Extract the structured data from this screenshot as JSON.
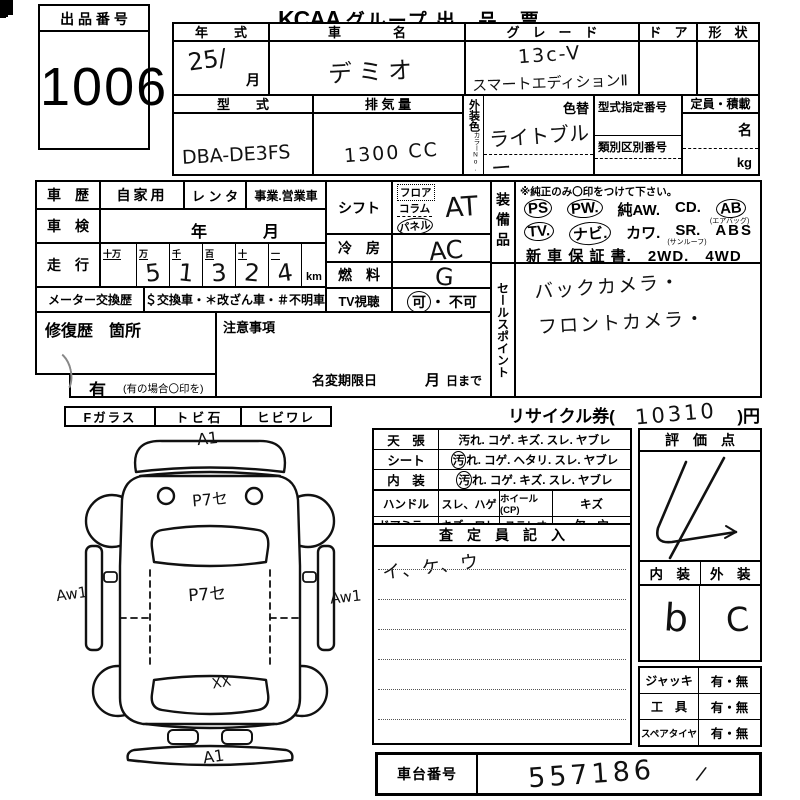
{
  "header": {
    "lot_label": "出 品 番 号",
    "lot_number": "1006",
    "brand": "KCAA",
    "title": "グループ 出　品　票",
    "audience": "主 催 者 用"
  },
  "row1": {
    "year_label": "年　　式",
    "year_value": "25/",
    "month_label": "月",
    "name_label": "車　　　　名",
    "name_value": "デミオ",
    "grade_label": "グ　レ　ー　ド",
    "grade_line1": "13c-V",
    "grade_line2": "スマートエディションⅡ",
    "door_label": "ド　ア",
    "shape_label": "形　状"
  },
  "row2": {
    "model_label": "型　　式",
    "model_value": "DBA-DE3FS",
    "disp_label": "排 気 量",
    "disp_value": "1300 CC",
    "color_side_label": "外装色",
    "color_no_label": "カラーNo.",
    "irogae_label": "色替",
    "color_value": "ライトブルー",
    "shitei_label": "型式指定番号",
    "ruibetsu_label": "類別区別番号",
    "capacity_label": "定員・積載",
    "persons_unit": "名",
    "weight_unit": "kg"
  },
  "history": {
    "label": "車　歴",
    "opt_private": "自家用",
    "opt_rental": "レ ン タ",
    "opt_business": "事業.営業車",
    "shaken_label": "車　検",
    "shaken_year": "年",
    "shaken_month": "月",
    "mileage_label": "走　行",
    "digit_headers": [
      "十万",
      "万",
      "千",
      "百",
      "十",
      "一"
    ],
    "digits": [
      "",
      "5",
      "1",
      "3",
      "2",
      "4"
    ],
    "unit": "km",
    "meter_label": "メーター交換歴",
    "meter_text": "＄交換車・＊改ざん車・＃不明車"
  },
  "repair": {
    "label": "修復歴　箇所",
    "notice_label": "注意事項",
    "yes_label": "有",
    "yes_note": "(有の場合〇印を)",
    "rename_label": "名変期限日",
    "month": "月",
    "day_suffix": "日まで"
  },
  "shift": {
    "label": "シフト",
    "opt_floor": "フロア",
    "opt_column": "コラム",
    "opt_panel": "パネル",
    "value": "AT",
    "ac_label": "冷　房",
    "ac_value": "AC",
    "fuel_label": "燃　料",
    "fuel_value": "G",
    "tv_label": "TV視聴",
    "tv_ok": "可",
    "tv_ng": "・ 不可"
  },
  "equipment": {
    "side_label": "装備品",
    "note": "※純正のみ〇印をつけて下さい。",
    "ps": "PS",
    "pw": "PW.",
    "aw": "純AW.",
    "cd": "CD.",
    "ab": "AB",
    "ab_sub": "(エアバッグ)",
    "tv": "TV.",
    "navi": "ナビ.",
    "kawa": "カワ.",
    "sr": "SR.",
    "sr_sub": "(サンルーフ)",
    "abs": "ABS",
    "line3": "新 車 保 証 書.　2WD.　4WD"
  },
  "sales": {
    "side_label": "セールスポイント",
    "line1": "バックカメラ・",
    "line2": "フロントカメラ・"
  },
  "recycle": {
    "pre": "リサイクル券(",
    "value": "10310",
    "post": ")円"
  },
  "glass": {
    "f": "Fガラス",
    "tobi": "ト ビ 石",
    "hibi": "ヒビワレ"
  },
  "diagram": {
    "a1_top": "A1",
    "p_upper": "P7セ",
    "p_center": "P7セ",
    "aw_left": "Aw1",
    "aw_right": "Aw1",
    "xx": "XX",
    "a1_bottom": "A1"
  },
  "condition": {
    "ceiling_label": "天　張",
    "ceiling_items": "汚れ. コゲ. キズ. スレ. ヤブレ",
    "seat_label": "シート",
    "seat_circled": "汚",
    "seat_items": "れ. コゲ. ヘタリ. スレ. ヤブレ",
    "interior_label": "内　装",
    "interior_circled": "汚",
    "interior_items": "れ. コゲ. キズ. スレ. ヤブレ",
    "handle_label": "ハンドル",
    "handle_items": "スレ、ハゲ",
    "wheel_label": "ホイール(CP)",
    "wheel_items": "キズ",
    "mirror_label": "ドアミラー",
    "mirror_items": "キズ、ワレ",
    "stereo_label": "ステレオ",
    "stereo_items": "欠、穴"
  },
  "assessor": {
    "title": "査　定　員　記　入",
    "note": "イ、ケ、ウ"
  },
  "score": {
    "title": "評　価　点",
    "value": "4",
    "interior_label": "内　装",
    "exterior_label": "外　装",
    "interior_value": "b",
    "exterior_value": "C"
  },
  "tools": {
    "rows": [
      {
        "label": "ジャッキ",
        "value": "有・無"
      },
      {
        "label": "工　具",
        "value": "有・無"
      },
      {
        "label": "スペアタイヤ",
        "value": "有・無"
      }
    ]
  },
  "chassis": {
    "label": "車台番号",
    "value": "557186",
    "tick": "/"
  }
}
